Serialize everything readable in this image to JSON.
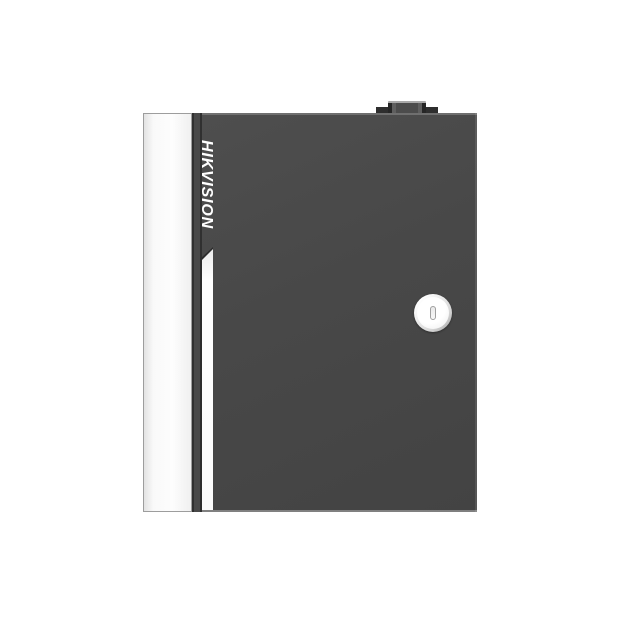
{
  "scene": {
    "type": "product-photo",
    "caption": "Dark gray metal access-control enclosure with white left side panel, vertical HIKVISION logo strip, white door groove, circular key lock and small top hinge knob on a plain white background",
    "background_color": "#ffffff"
  },
  "device": {
    "brand_logo": "HIKVISION",
    "logo_orientation": "rotated-90-clockwise",
    "colors": {
      "door_body": "#484848",
      "door_edge": "#2f2f2f",
      "side_panel": "#fbfbfb",
      "side_panel_border": "#9d9d9d",
      "logo_text": "#ffffff",
      "groove": "#ffffff",
      "groove_shadow": "#2d2d2d",
      "lock_ring": "#d6d6d6",
      "lock_face": "#ffffff",
      "keyhole_outline": "#9f9f9f",
      "top_knob": "#4c4c4c",
      "knob_highlight": "#a9a9a9"
    },
    "lock_type": "circular cam lock with vertical key slot",
    "features": [
      "top hinge knob",
      "white side panel",
      "vertical logo strip",
      "door groove stripe",
      "circular key lock"
    ]
  }
}
